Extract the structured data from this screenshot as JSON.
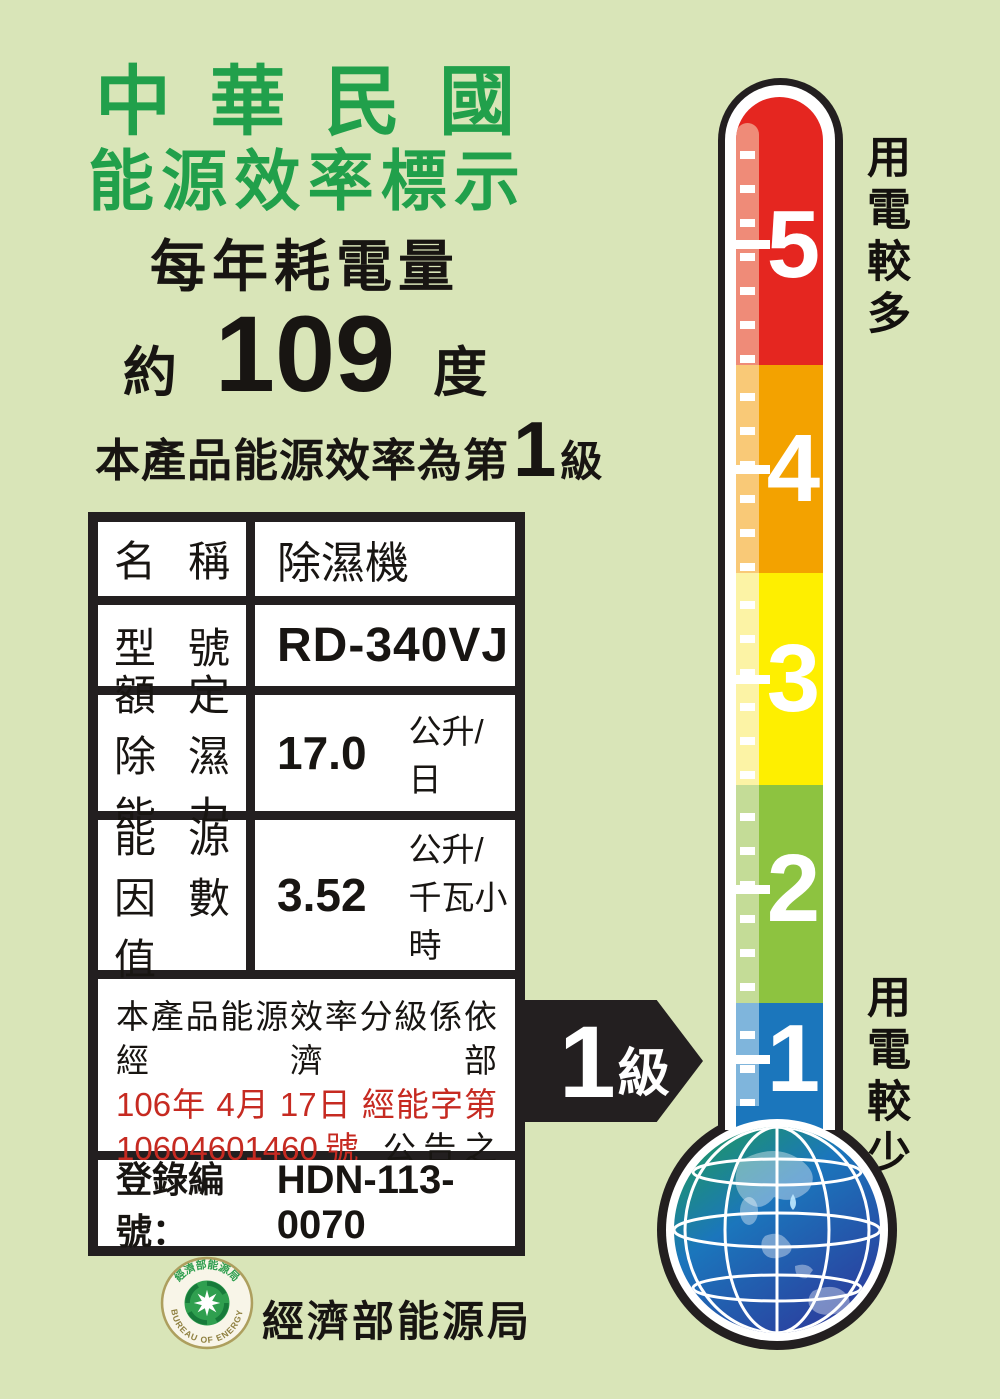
{
  "header": {
    "title_line1": "中華民國",
    "title_line2": "能源效率標示",
    "subtitle": "每年耗電量"
  },
  "consumption": {
    "prefix": "約",
    "value": "109",
    "unit": "度"
  },
  "grade_line": {
    "prefix": "本產品能源效率為第",
    "number": "1",
    "suffix": "級"
  },
  "table": {
    "rows": [
      {
        "label": "名稱",
        "value": "除濕機"
      },
      {
        "label": "型號",
        "value": "RD-340VJ"
      },
      {
        "label_line1": "額定",
        "label_line2": "除濕能力",
        "value": "17.0",
        "unit": "公升/日"
      },
      {
        "label_line1": "能源",
        "label_line2": "因數值",
        "value": "3.52",
        "unit": "公升/千瓦小時"
      }
    ],
    "notice": {
      "line1": "本產品能源效率分級係依經濟部",
      "line2_red": "106年 4月 17日 經能字第",
      "line3_red": "10604601460號",
      "line3_black": "公告之",
      "line4": "能源效率分級基準表標示"
    },
    "registration_label": "登錄編號：",
    "registration_number": "HDN-113-0070"
  },
  "footer": {
    "bureau_name": "經濟部能源局",
    "seal_text_top": "經濟部能源局",
    "seal_text_bottom": "BUREAU OF ENERGY"
  },
  "thermometer": {
    "label_more": "用電較多",
    "label_less": "用電較少",
    "arrow": {
      "number": "1",
      "suffix": "級"
    },
    "levels": [
      {
        "value": "5",
        "color": "#e52620",
        "stripe_color": "#ef8b78"
      },
      {
        "value": "4",
        "color": "#f3a200",
        "stripe_color": "#f9c977"
      },
      {
        "value": "3",
        "color": "#feef00",
        "stripe_color": "#fcf3a5"
      },
      {
        "value": "2",
        "color": "#8dc340",
        "stripe_color": "#c4dc97"
      },
      {
        "value": "1",
        "color": "#1b76bc",
        "stripe_color": "#7fb5dc"
      }
    ]
  },
  "colors": {
    "background": "#d9e5b8",
    "title_green": "#21a04b",
    "outline_black": "#231f20",
    "notice_red": "#c62a21",
    "globe_green": "#1f9e52",
    "globe_blue": "#1b5cae"
  }
}
